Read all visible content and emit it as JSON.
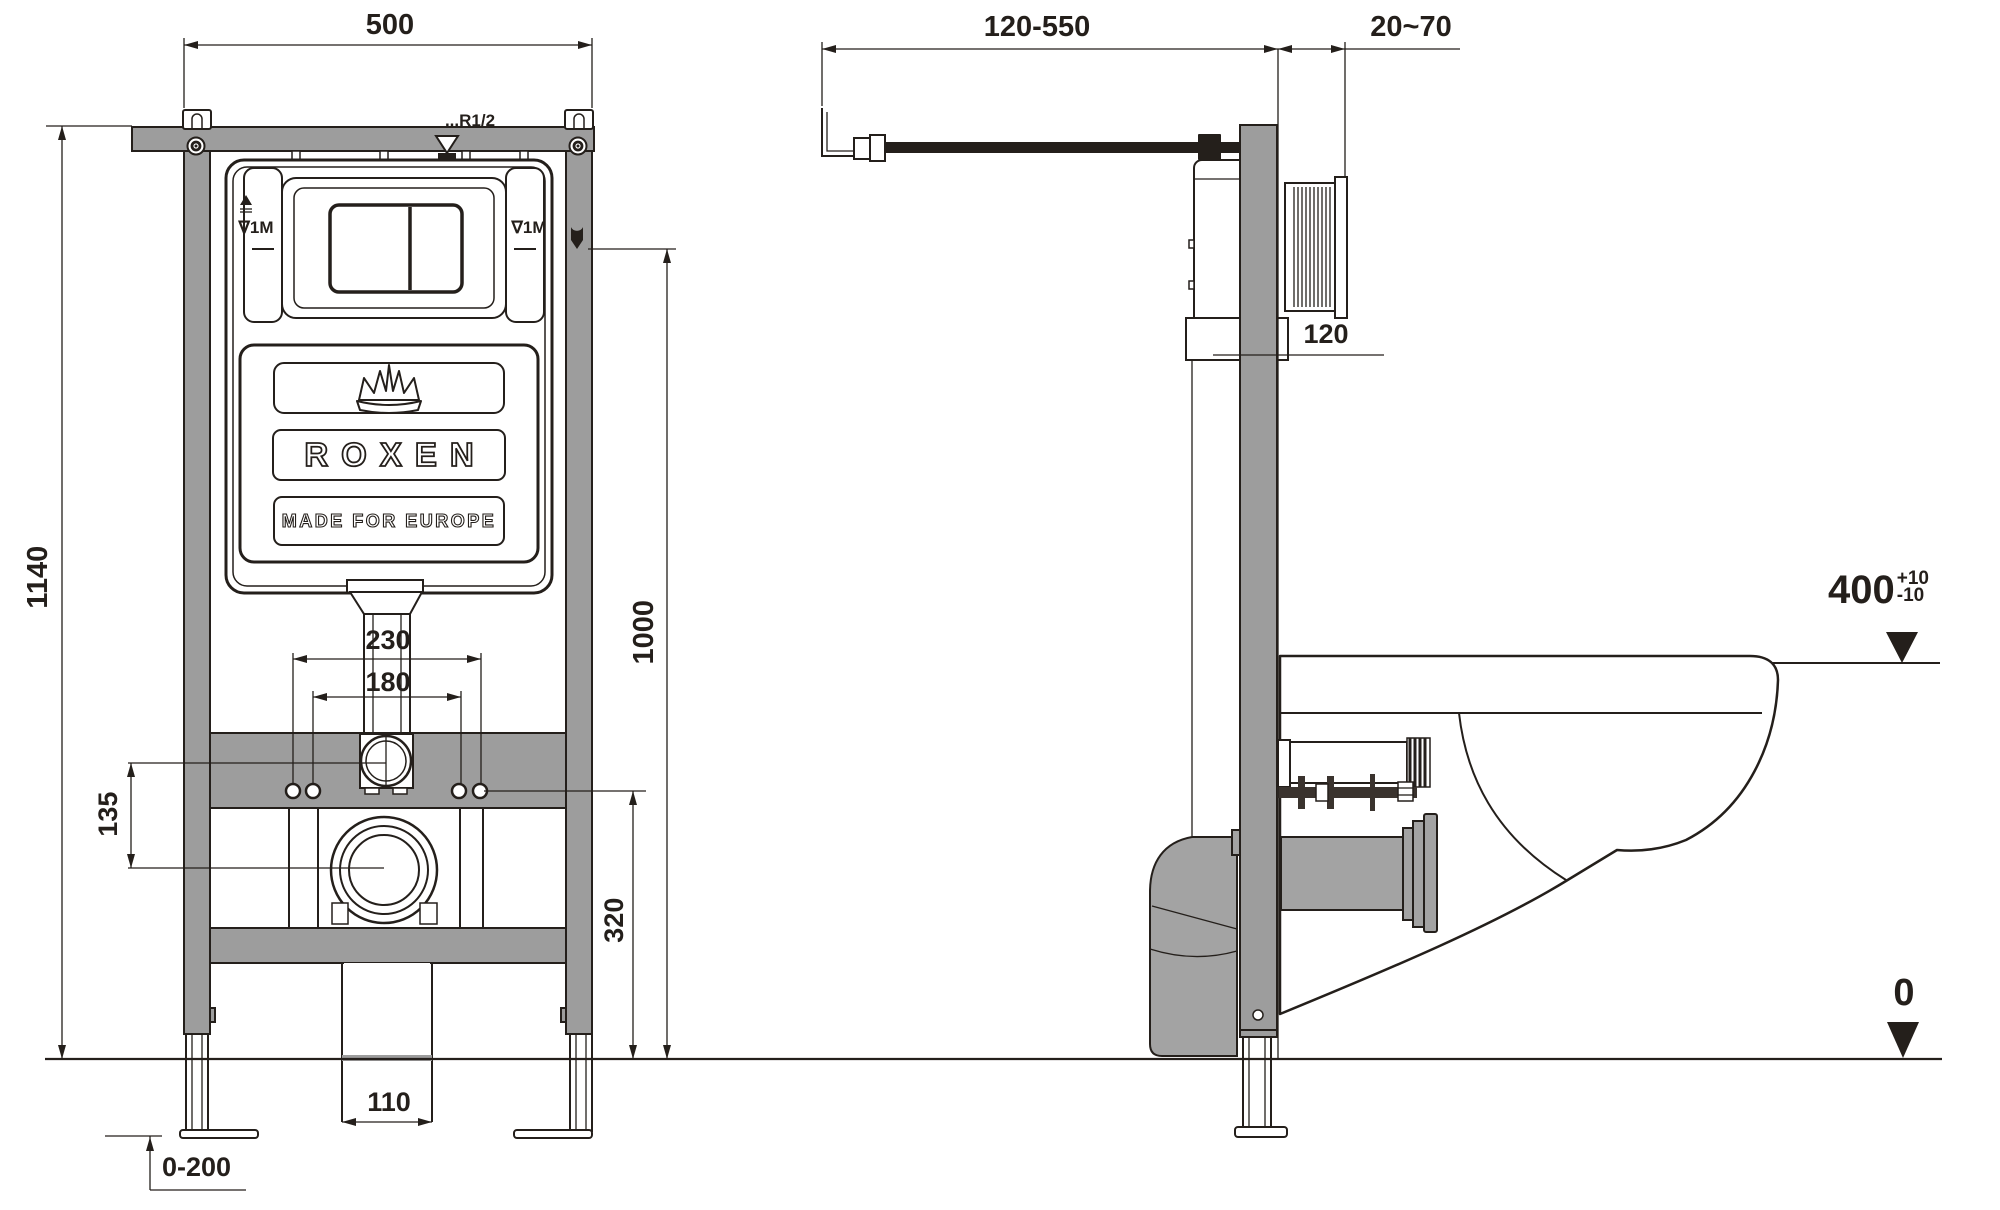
{
  "drawing": {
    "front": {
      "dims": {
        "overall_width": "500",
        "overall_height": "1140",
        "upper_height": "1000",
        "bolt_span_outer": "230",
        "bolt_span_inner": "180",
        "inlet_to_drain": "135",
        "drain_height": "320",
        "outlet_width": "110",
        "leg_adjustment": "0-200"
      },
      "labels": {
        "water_thread": "...R1/2",
        "water_level_left": "∇1M",
        "water_level_right": "∇1M"
      },
      "logo": {
        "brand": "ROXEN",
        "tagline": "MADE FOR EUROPE"
      }
    },
    "side": {
      "dims": {
        "supply_offset": "120-550",
        "wall_finish": "20~70",
        "frame_depth": "120"
      },
      "levels": {
        "rim_value": "400",
        "rim_tol_plus": "+10",
        "rim_tol_minus": "-10",
        "floor": "0"
      }
    },
    "colors": {
      "line": "#241f1b",
      "frame_gray": "#9d9d9d",
      "metal_gray": "#a3a3a3",
      "background": "#ffffff"
    }
  }
}
